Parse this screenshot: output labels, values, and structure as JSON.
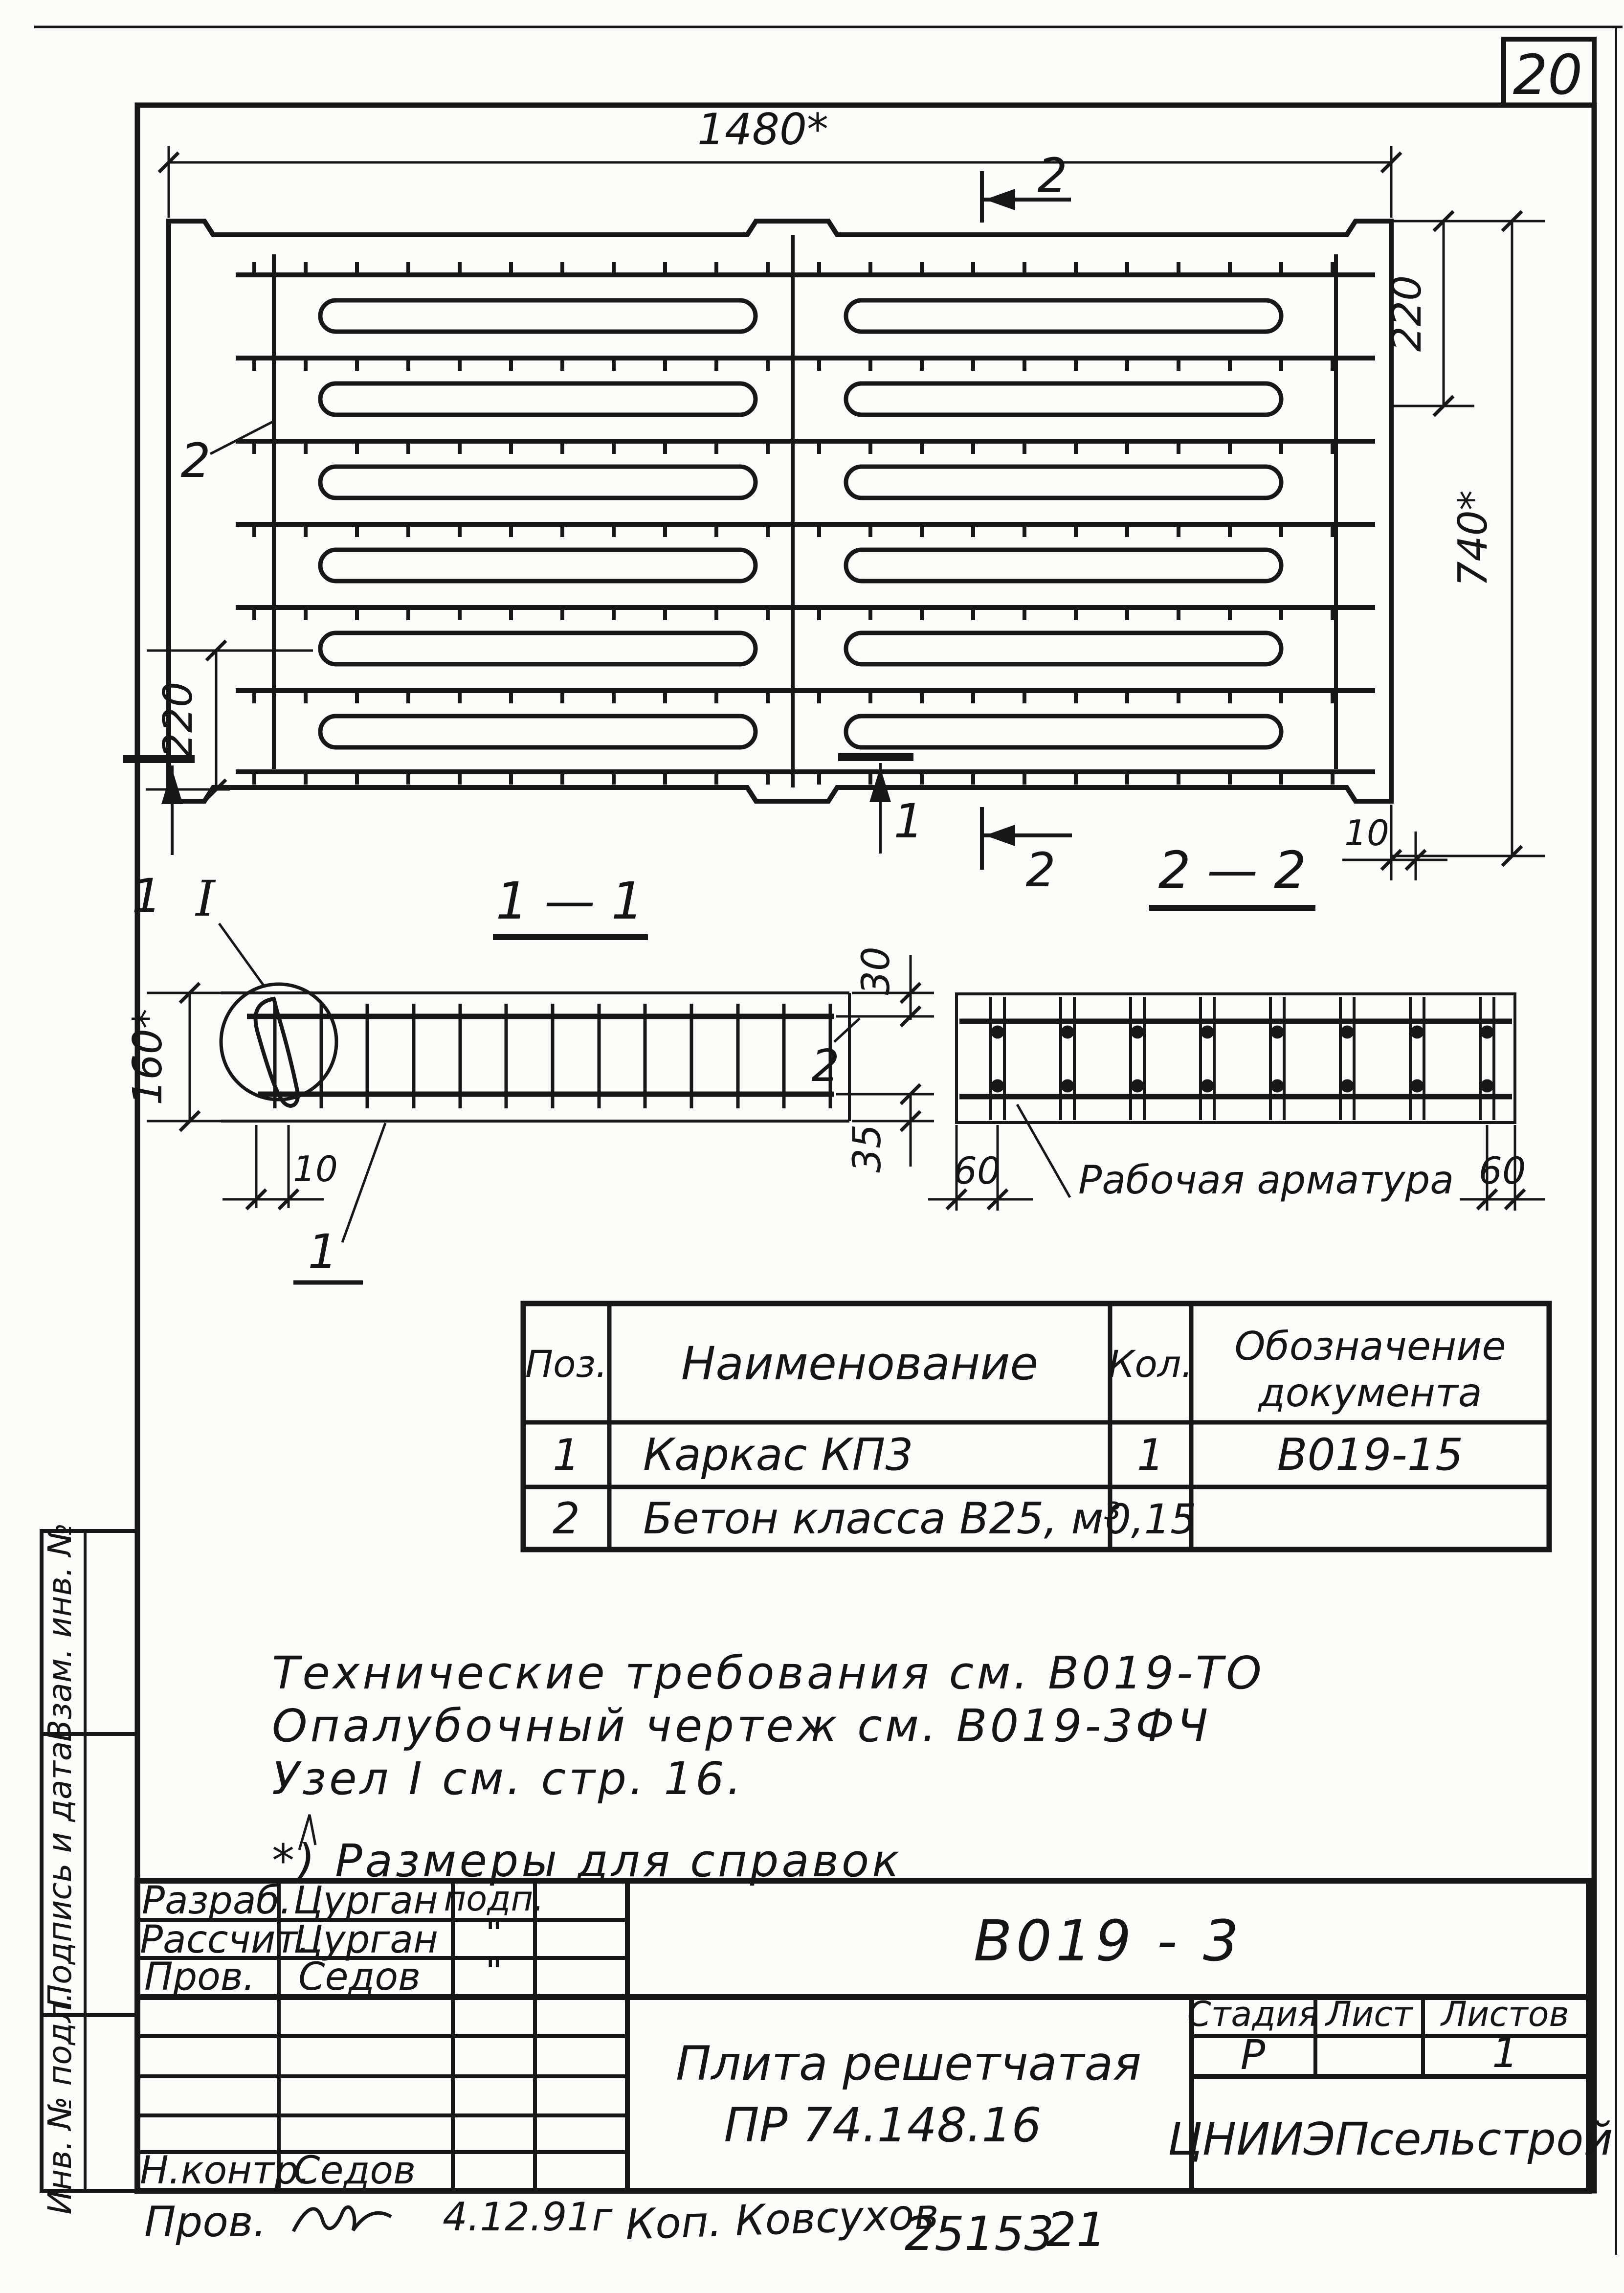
{
  "page_number": "20",
  "plan": {
    "dim_width": "1480*",
    "dim_right_top": "220",
    "dim_right_full": "740*",
    "dim_left": "220",
    "dim_gap": "10",
    "leader_concrete": "2",
    "cut1_left": "1",
    "cut1_mid": "1",
    "cut2_top": "2",
    "cut2_bottom": "2"
  },
  "section11": {
    "title": "1 — 1",
    "node": "I",
    "dim_height": "160*",
    "dim_hook": "10",
    "dim_top_cover": "30",
    "dim_bottom_cover": "35",
    "leader_frame": "1",
    "leader_concrete": "2"
  },
  "section22": {
    "title": "2 — 2",
    "dim_left": "60",
    "dim_right": "60",
    "label_rebar": "Рабочая арматура"
  },
  "spec": {
    "col_pos": "Поз.",
    "col_name": "Наименование",
    "col_qty": "Кол.",
    "col_doc1": "Обозначение",
    "col_doc2": "документа",
    "rows": [
      {
        "pos": "1",
        "name": "Каркас КП3",
        "qty": "1",
        "doc": "В019-15"
      },
      {
        "pos": "2",
        "name": "Бетон класса В25, м³",
        "qty": "0,15",
        "doc": ""
      }
    ]
  },
  "notes": {
    "line1": "Технические требования см. В019-ТО",
    "line2": "Опалубочный чертеж см. В019-3ФЧ",
    "line3": "Узел I см. стр. 16.",
    "line4": "*) Размеры для справок"
  },
  "titleblock": {
    "doc_number": "В019 - 3",
    "title1": "Плита решетчатая",
    "title2": "ПР 74.148.16",
    "org": "ЦНИИЭПсельстрой",
    "stage_h": "Стадия",
    "sheet_h": "Лист",
    "sheets_h": "Листов",
    "stage_v": "Р",
    "sheet_v": "",
    "sheets_v": "1",
    "sig_label": "подп.",
    "ditto": "\"",
    "rows": [
      {
        "role": "Разраб.",
        "name": "Цурган"
      },
      {
        "role": "Рассчит.",
        "name": "Цурган"
      },
      {
        "role": "Пров.",
        "name": "Седов"
      },
      {
        "role": "Н.контр.",
        "name": "Седов"
      }
    ]
  },
  "strip": {
    "c1": "Взам. инв. №",
    "c2": "Подпись и дата",
    "c3": "Инв. № подл."
  },
  "footer": {
    "prov": "Пров.",
    "date": "4.12.91г",
    "kop": "Коп. Ковсухов",
    "num": "25153",
    "page": "21"
  }
}
